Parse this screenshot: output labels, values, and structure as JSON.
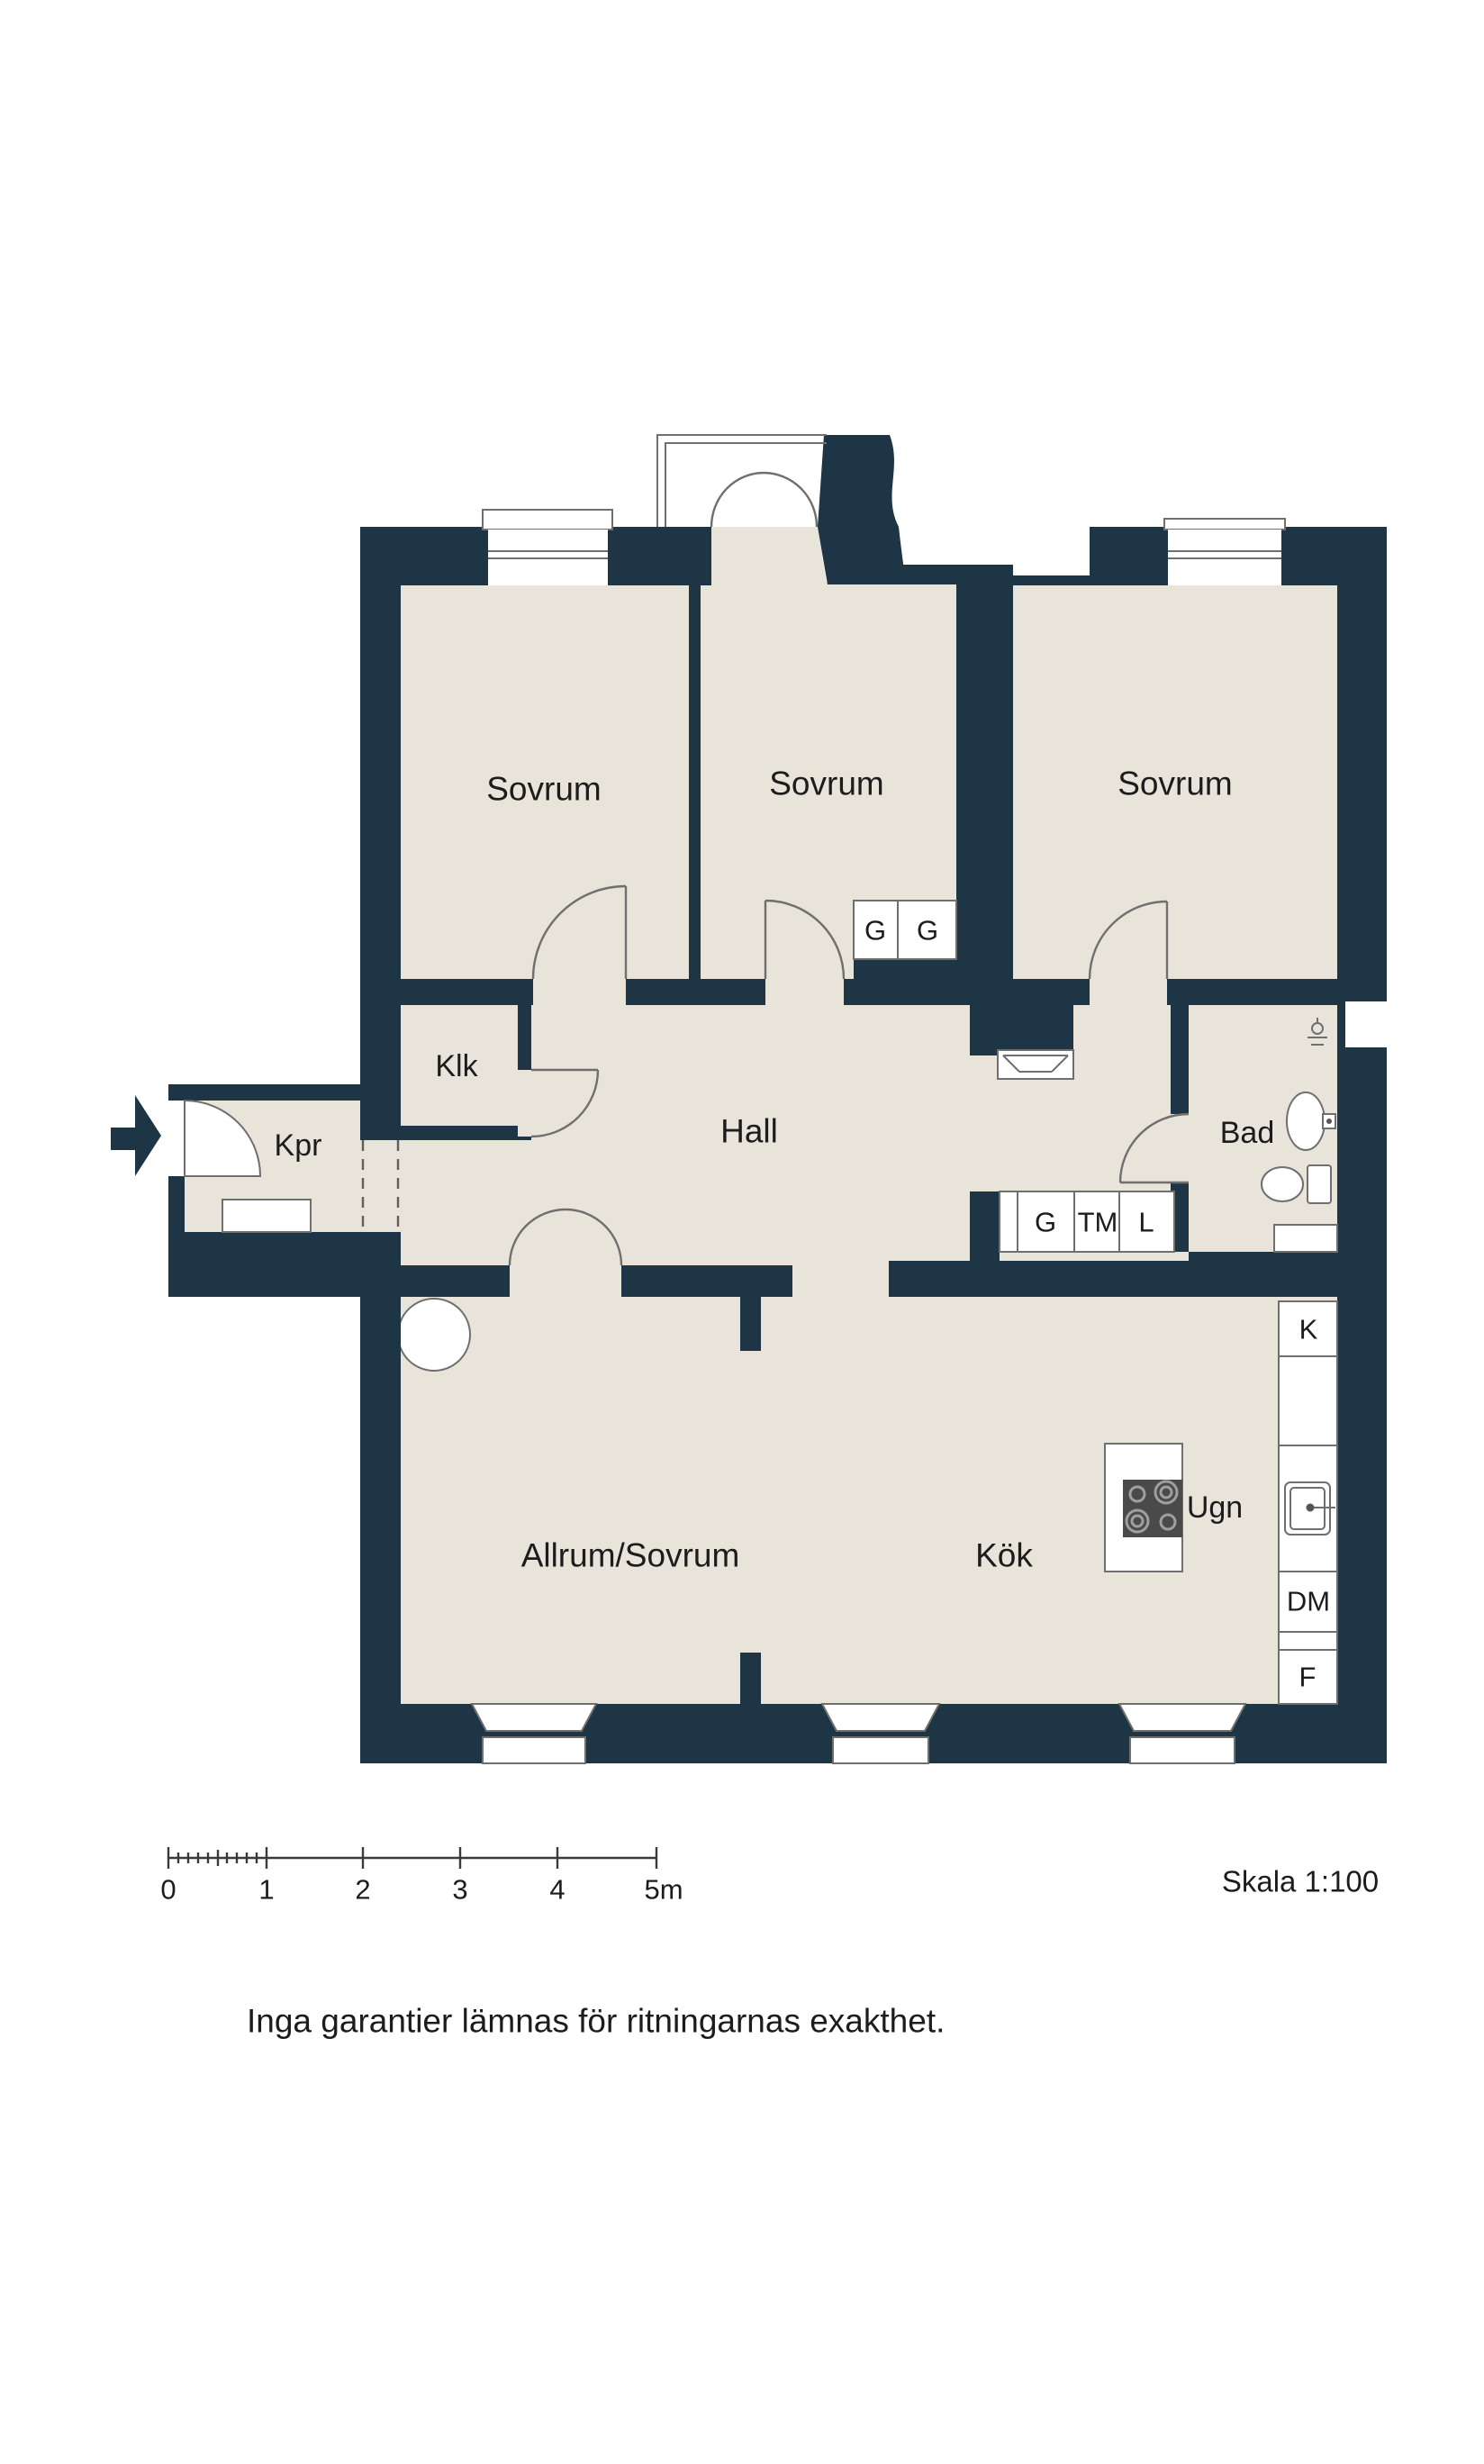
{
  "colors": {
    "wall": "#1d3544",
    "floor": "#e8e4d9",
    "line": "#6f6f6f",
    "text": "#1c1c1c",
    "stove": "#4a4a4a"
  },
  "rooms": {
    "bedroom_left": "Sovrum",
    "bedroom_middle": "Sovrum",
    "bedroom_right": "Sovrum",
    "closet": "Klk",
    "entry": "Kpr",
    "hall": "Hall",
    "bathroom": "Bad",
    "living": "Allrum/Sovrum",
    "kitchen": "Kök"
  },
  "fixtures": {
    "wardrobe_a": "G",
    "wardrobe_b": "G",
    "wardrobe_hall": "G",
    "washing_machine": "TM",
    "linen_closet": "L",
    "fridge": "K",
    "dishwasher": "DM",
    "freezer": "F",
    "oven": "Ugn"
  },
  "scale_bar": {
    "labels": [
      "0",
      "1",
      "2",
      "3",
      "4",
      "5m"
    ]
  },
  "scale_note": "Skala 1:100",
  "disclaimer": "Inga garantier lämnas för ritningarnas exakthet."
}
